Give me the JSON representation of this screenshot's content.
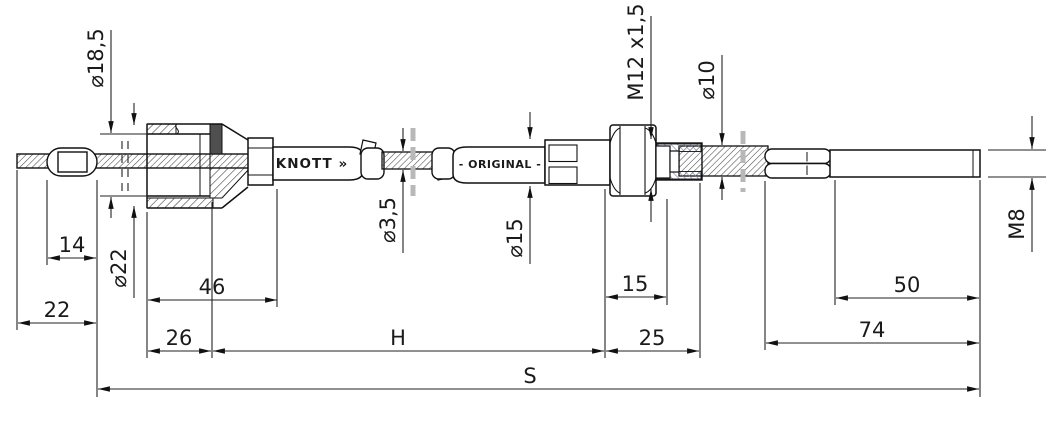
{
  "drawing": {
    "brand": "KNOTT »",
    "sheath_marking": "- ORIGINAL -",
    "dim_labels": {
      "housing_bore_dia": "⌀18,5",
      "housing_outer_dia": "⌀22",
      "nipple_length": "14",
      "front_cable_stub": "22",
      "housing_length": "46",
      "housing_cyl_length": "26",
      "outer_casing_length": "H",
      "overall_length": "S",
      "inner_cable_dia": "⌀3,5",
      "adjuster_dia": "⌀15",
      "thread_spec": "M12 x1,5",
      "rear_cable_dia": "⌀10",
      "thread_stub_length": "15",
      "abutment_length": "25",
      "rod_thread_length": "50",
      "rod_length": "74",
      "rod_thread_spec": "M8"
    }
  }
}
